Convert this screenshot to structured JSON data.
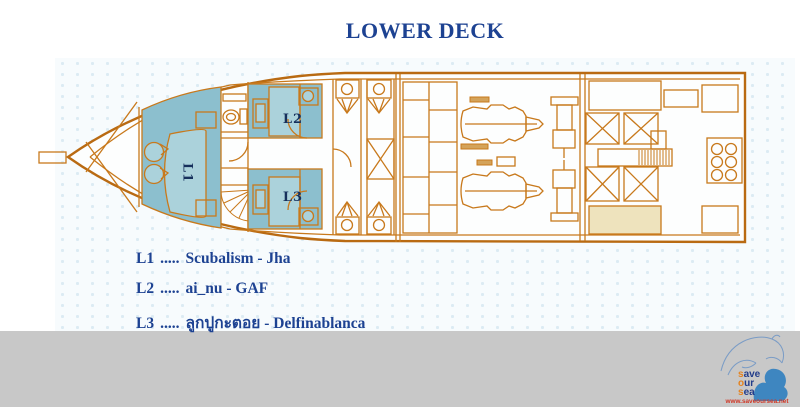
{
  "title": "LOWER DECK",
  "plan": {
    "cabins": [
      {
        "id": "L1"
      },
      {
        "id": "L2"
      },
      {
        "id": "L3"
      }
    ]
  },
  "legend": {
    "items": [
      {
        "code": "L1",
        "dots": ".....",
        "name": "Scubalism - Jha"
      },
      {
        "code": "L2",
        "dots": ".....",
        "name": "ai_nu - GAF"
      },
      {
        "code": "L3",
        "dots": ".....",
        "name": "ลูกปูกะตอย - Delfinablanca"
      }
    ]
  },
  "footer": {
    "logo": {
      "lines": [
        {
          "first": "s",
          "rest": "ave"
        },
        {
          "first": "o",
          "rest": "ur"
        },
        {
          "first": "s",
          "rest": "ea"
        }
      ],
      "url": "www.saveoursea.net"
    }
  },
  "colors": {
    "accent_orange": "#c8791c",
    "hull_orange": "#b96a12",
    "cabin_teal": "#8cbfce",
    "navy": "#1d4292",
    "footer_gray": "#c8c8c8",
    "logo_red": "#cf3726",
    "logo_blue": "#3e86c0"
  }
}
